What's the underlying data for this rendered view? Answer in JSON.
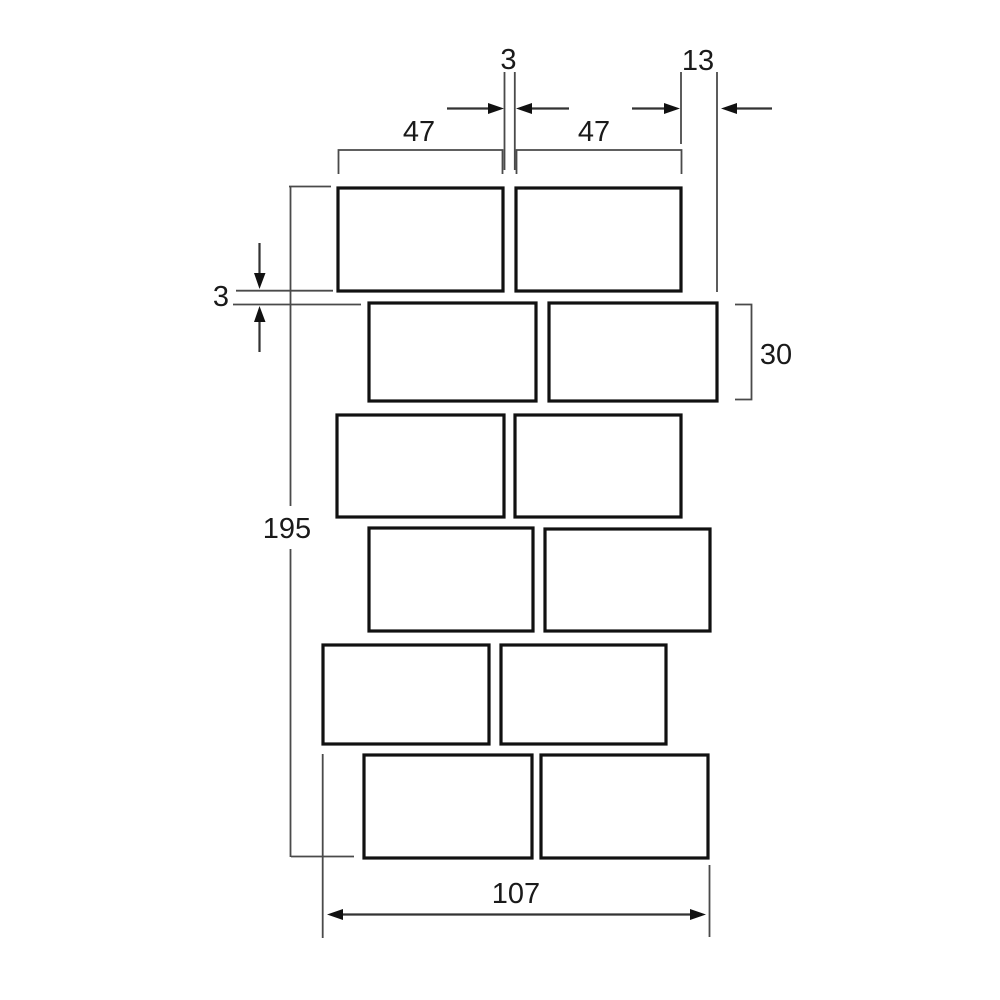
{
  "diagram": {
    "description": "Staggered brick pattern dimension drawing",
    "bricks": {
      "rows": 6,
      "bricks_per_row": 2,
      "total": 12
    },
    "colors": {
      "background": "#ffffff",
      "ink": "#111111",
      "dim_line": "#4a4a4a",
      "text": "#1a1a1a"
    }
  },
  "labels": {
    "head_joint_gap": "3",
    "row_offset": "13",
    "brick_width_left": "47",
    "brick_width_right": "47",
    "brick_height": "30",
    "bed_joint_gap": "3",
    "total_height": "195",
    "total_width": "107"
  }
}
